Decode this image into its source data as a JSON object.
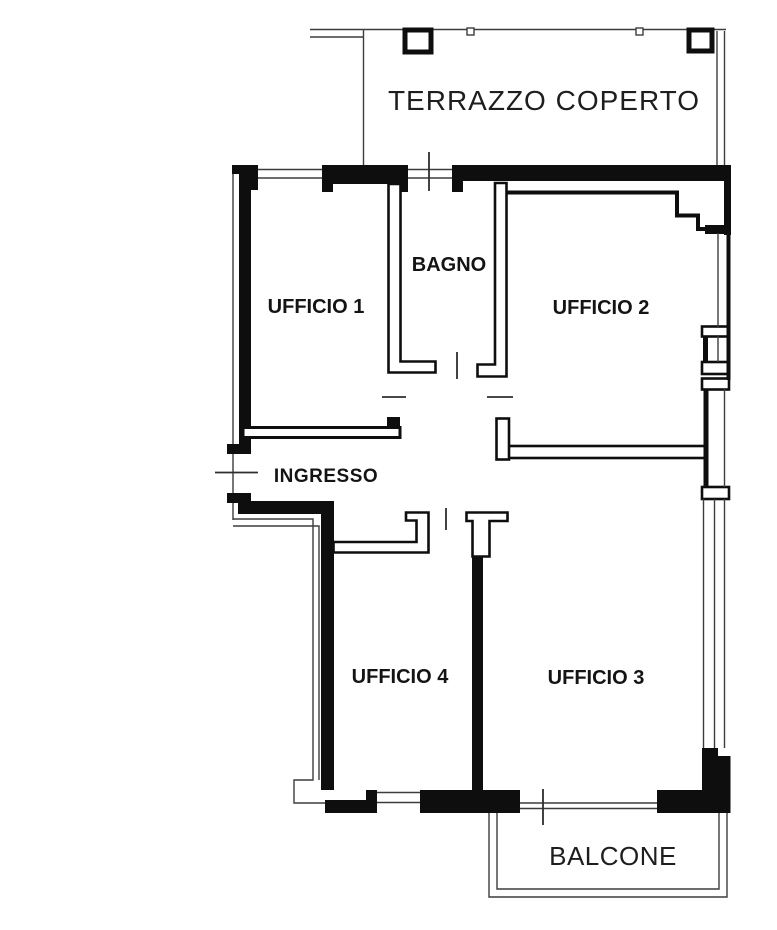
{
  "rooms": {
    "terrazzo": "TERRAZZO COPERTO",
    "ufficio1": "UFFICIO 1",
    "bagno": "BAGNO",
    "ufficio2": "UFFICIO 2",
    "ingresso": "INGRESSO",
    "ufficio4": "UFFICIO 4",
    "ufficio3": "UFFICIO 3",
    "balcone": "BALCONE"
  },
  "colors": {
    "background": "#ffffff",
    "wall": "#0e0e0e",
    "thin_line": "#3d3d3d",
    "label": "#141414"
  }
}
